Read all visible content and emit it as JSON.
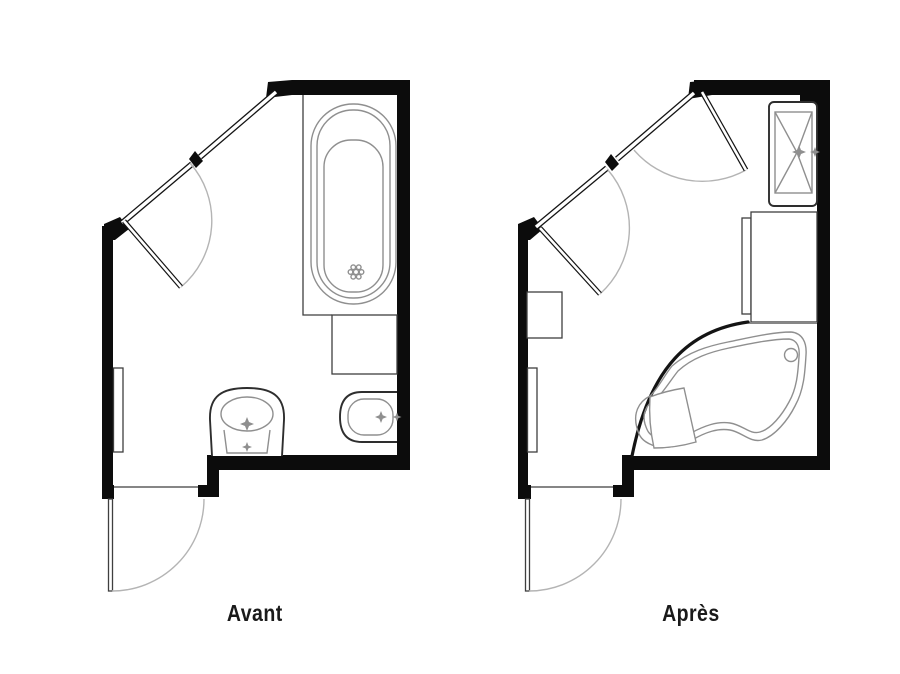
{
  "figure": {
    "type": "floor-plan-comparison",
    "background": "#ffffff"
  },
  "colors": {
    "page_bg": "#ffffff",
    "wall": "#0c0c0c",
    "fixture_outline": "#2e2e2e",
    "fixture_detail": "#8f8f8f",
    "door_arc": "#b4b4b4",
    "thin_line": "#3f3f3f",
    "label_text": "#1a1a1a"
  },
  "plans": [
    {
      "label": "Avant",
      "fixtures": [
        "window-diagonal",
        "swing-door",
        "bathtub",
        "tub-shelf",
        "toilet",
        "bidet",
        "radiator",
        "entry-door"
      ]
    },
    {
      "label": "Après",
      "fixtures": [
        "window-diagonal",
        "swing-door-upper",
        "swing-door-lower",
        "vanity-sink",
        "cabinet",
        "corner-bathtub",
        "storage-unit",
        "radiator",
        "entry-door"
      ]
    }
  ]
}
